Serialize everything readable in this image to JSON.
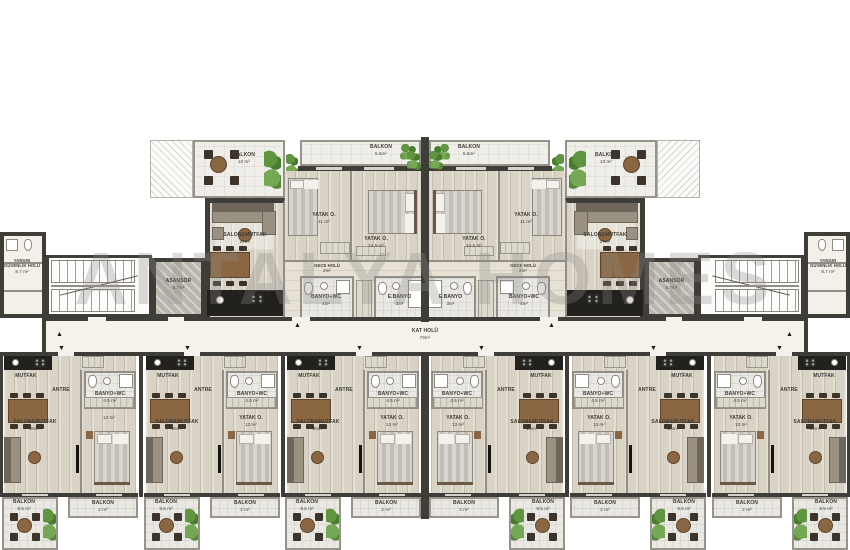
{
  "watermark": "ANTALYA HOMES",
  "corridor": {
    "name": "KAT HOLÜ",
    "area": "79m²"
  },
  "circulation": {
    "fire_hall": {
      "name": "YANGIN GÜVENLİK HOLÜ",
      "area": "8.7 m²"
    },
    "elevator": {
      "name": "ASANSÖR",
      "area": "6.7m²"
    }
  },
  "top_unit": {
    "corner_balcony": {
      "name": "BALKON",
      "area": "10 m²"
    },
    "balcony": {
      "name": "BALKON",
      "area": "5.5m²"
    },
    "living": {
      "name": "SALON&MUTFAK",
      "area": "27m²"
    },
    "bedroom_small": {
      "name": "YATAK O.",
      "area": "11 m²"
    },
    "bedroom_large": {
      "name": "YATAK O.",
      "area": "14.5 m²"
    },
    "night_hall": {
      "name": "GECE HOLÜ",
      "area": "2m²"
    },
    "bathroom": {
      "name": "BANYO+WC",
      "area": "4m²"
    },
    "ensuite": {
      "name": "E.BANYO",
      "area": "3m²"
    }
  },
  "garden_unit": {
    "kitchen": {
      "name": "MUTFAK"
    },
    "entry": {
      "name": "ANTRE"
    },
    "bathroom": {
      "name": "BANYO+WC",
      "area": "4.5 m²"
    },
    "living": {
      "name": "SALON&MUTFAK",
      "area": "26m²"
    },
    "bedroom": {
      "name": "YATAK O.",
      "area": "13 m²"
    },
    "balcony_large": {
      "name": "BALKON",
      "area": "9.5 m²"
    },
    "balcony_small": {
      "name": "BALKON",
      "area": "2 m²"
    }
  },
  "symbols": {
    "arrow_up": "▲",
    "arrow_down": "▼"
  }
}
